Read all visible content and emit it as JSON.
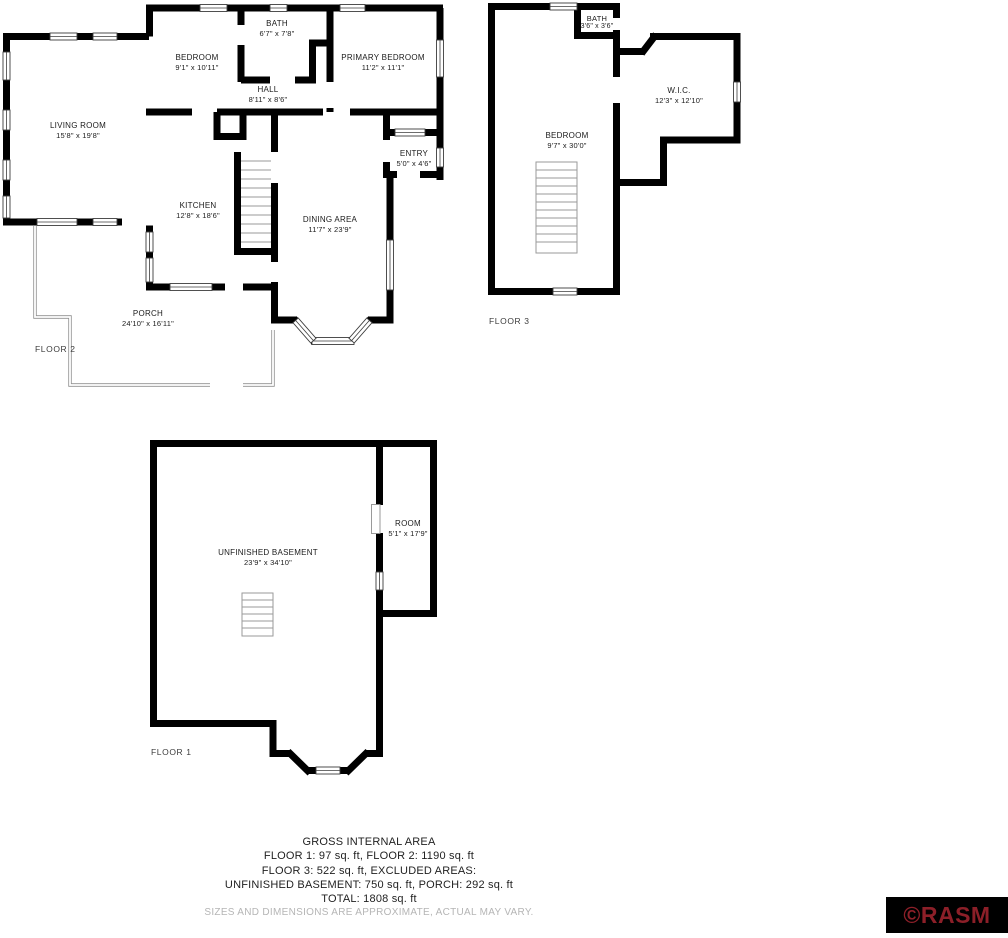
{
  "floors": {
    "floor2": {
      "label": "FLOOR 2",
      "rooms": {
        "living_room": {
          "name": "LIVING ROOM",
          "dims": "15'8\" x 19'8\""
        },
        "bedroom": {
          "name": "BEDROOM",
          "dims": "9'1\" x 10'11\""
        },
        "bath": {
          "name": "BATH",
          "dims": "6'7\" x 7'8\""
        },
        "hall": {
          "name": "HALL",
          "dims": "8'11\" x 8'6\""
        },
        "primary_bedroom": {
          "name": "PRIMARY BEDROOM",
          "dims": "11'2\" x 11'1\""
        },
        "entry": {
          "name": "ENTRY",
          "dims": "5'0\" x 4'6\""
        },
        "kitchen": {
          "name": "KITCHEN",
          "dims": "12'8\" x 18'6\""
        },
        "dining_area": {
          "name": "DINING AREA",
          "dims": "11'7\" x 23'9\""
        },
        "porch": {
          "name": "PORCH",
          "dims": "24'10\" x 16'11\""
        }
      }
    },
    "floor3": {
      "label": "FLOOR 3",
      "rooms": {
        "bath": {
          "name": "BATH",
          "dims": "3'6\" x 3'6\""
        },
        "bedroom": {
          "name": "BEDROOM",
          "dims": "9'7\" x 30'0\""
        },
        "wic": {
          "name": "W.I.C.",
          "dims": "12'3\" x 12'10\""
        }
      }
    },
    "floor1": {
      "label": "FLOOR 1",
      "rooms": {
        "unfinished_basement": {
          "name": "UNFINISHED BASEMENT",
          "dims": "23'9\" x 34'10\""
        },
        "room": {
          "name": "ROOM",
          "dims": "5'1\" x 17'9\""
        }
      }
    }
  },
  "summary": {
    "title": "GROSS INTERNAL AREA",
    "line2": "FLOOR 1: 97 sq. ft, FLOOR 2: 1190 sq. ft",
    "line3": "FLOOR 3: 522 sq. ft, EXCLUDED AREAS:",
    "line4": "UNFINISHED BASEMENT: 750 sq. ft, PORCH: 292 sq. ft",
    "line5": "TOTAL: 1808 sq. ft",
    "disclaimer": "SIZES AND DIMENSIONS ARE APPROXIMATE, ACTUAL MAY VARY."
  },
  "watermark": {
    "text": "©RASM",
    "color": "#8C1F28",
    "background": "#000000"
  },
  "colors": {
    "walls": "#000000",
    "porch_outline": "#8f8f8f",
    "stairs": "#9a9a9a",
    "disclaimer_text": "#b5b5b5"
  }
}
